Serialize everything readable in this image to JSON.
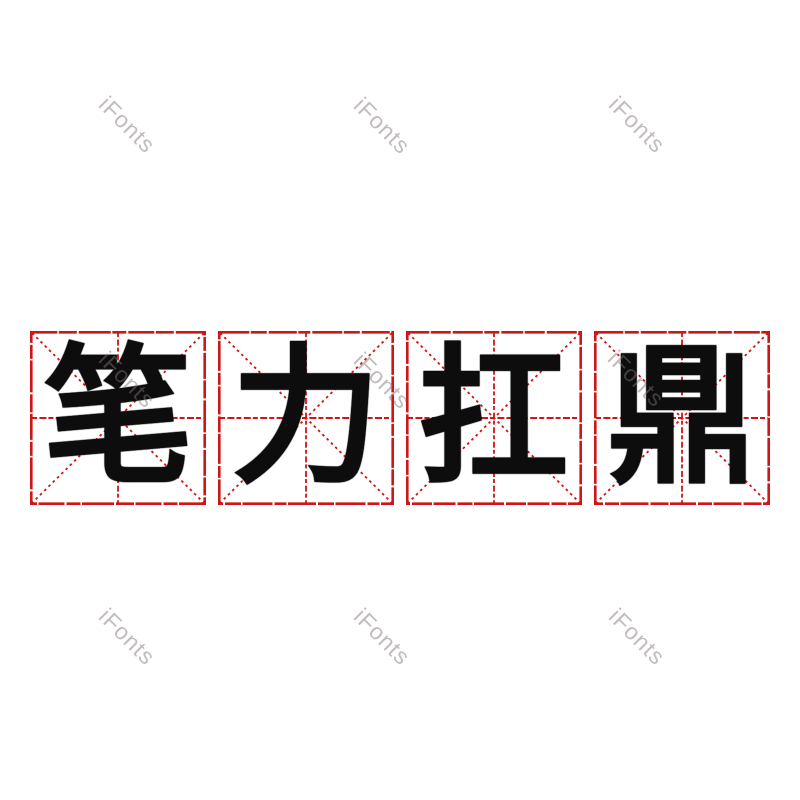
{
  "page": {
    "kind": "font-preview-image",
    "background_color": "#ffffff"
  },
  "phrase": {
    "text": "笔力扛鼎",
    "style": "bold rounded cartoon calligraphy, black ink"
  },
  "cells": [
    {
      "char": "笔"
    },
    {
      "char": "力"
    },
    {
      "char": "扛"
    },
    {
      "char": "鼎"
    }
  ],
  "grid": {
    "type": "mizige-practice-square",
    "box_count": 4,
    "line_color": "#cf1616",
    "elements": [
      "outer square border",
      "corner-to-corner diagonals",
      "horizontal center dashed line",
      "vertical center dashed line"
    ]
  },
  "watermark": {
    "text": "iFonts",
    "count": 9,
    "rotation_deg": 45,
    "color": "#8a7272"
  },
  "colors": {
    "grid_red": "#cf1616",
    "ink_black": "#0d0d0d",
    "background": "#ffffff",
    "watermark_gray": "#c9c0c0"
  }
}
